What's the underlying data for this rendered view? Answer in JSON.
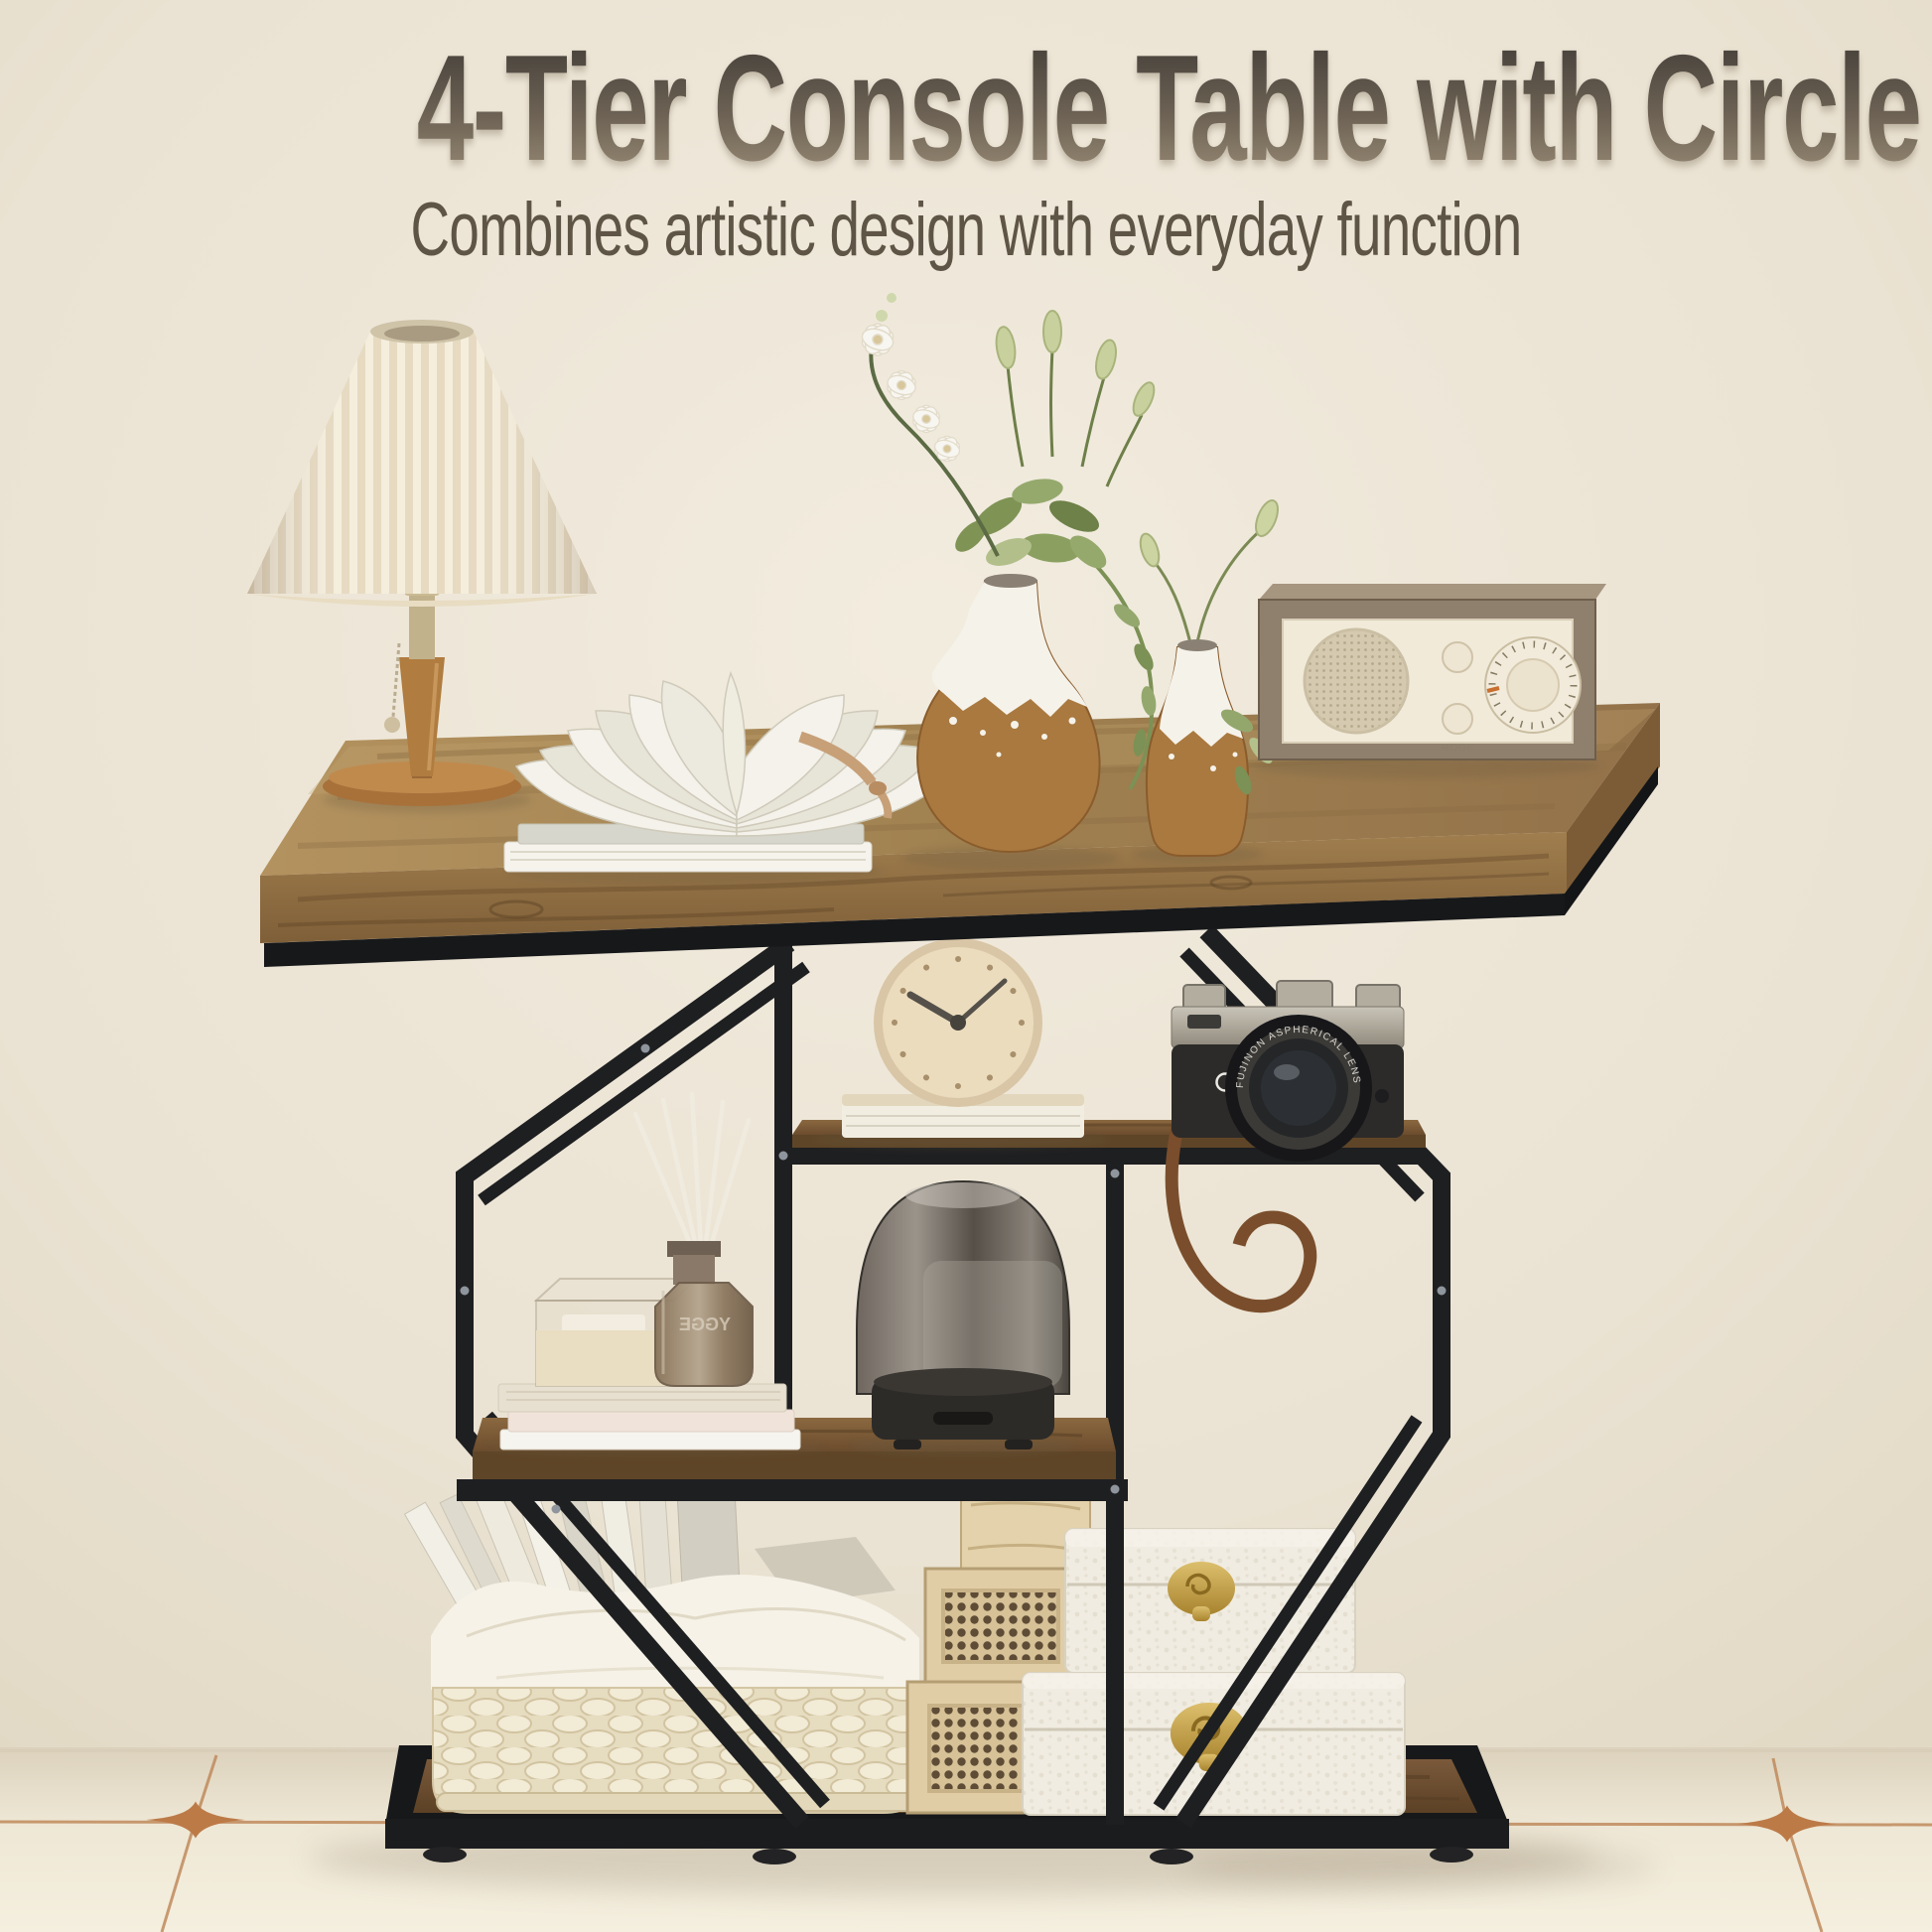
{
  "header": {
    "title": "4-Tier Console Table with Circle Base",
    "subtitle": "Combines artistic design with everyday function"
  },
  "scene": {
    "radio": {
      "mode_label": "MODE"
    },
    "diffuser": {
      "brand_label": "YGGE"
    },
    "camera": {
      "lens_ring_text": "FUJINON ASPHERICAL LENS"
    },
    "colors": {
      "wall": "#ece5d6",
      "floor": "#f2ecdb",
      "tile_accent": "#bc7a47",
      "metal_frame": "#1e1f21",
      "tabletop_wood": "#9c7c4c",
      "shelf_wood": "#6e5136",
      "headline_top": "#45403a",
      "headline_bottom": "#9a8c76",
      "subtitle_text": "#5f5546"
    }
  }
}
